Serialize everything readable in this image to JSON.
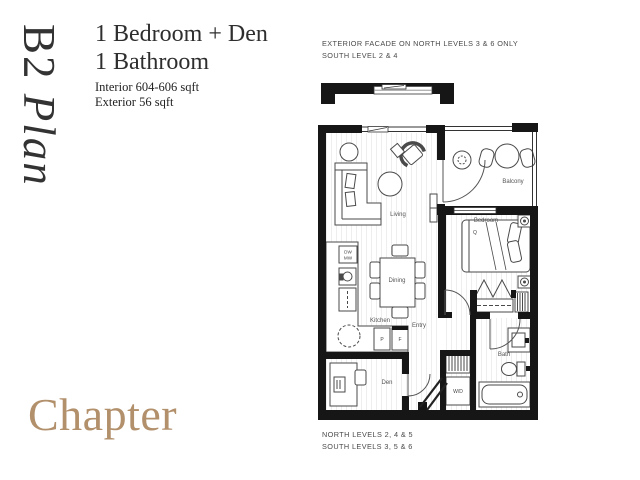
{
  "header": {
    "plan_code": "B2",
    "plan_word": "Plan",
    "title_line1": "1 Bedroom + Den",
    "title_line2": "1 Bathroom",
    "interior": "Interior 604-606 sqft",
    "exterior": "Exterior 56 sqft"
  },
  "facade_note": {
    "line1": "EXTERIOR FACADE ON NORTH LEVELS 3 & 6 ONLY",
    "line2": "SOUTH LEVEL 2 & 4"
  },
  "levels_note": {
    "line1": "NORTH LEVELS 2, 4 & 5",
    "line2": "SOUTH LEVELS 3, 5 & 6"
  },
  "brand": {
    "name": "Chapter",
    "color": "#b2906c"
  },
  "floorplan": {
    "labels": {
      "living": "Living",
      "dining": "Dining",
      "kitchen": "Kitchen",
      "den": "Den",
      "entry": "Entry",
      "balcony": "Balcony",
      "bedroom": "Bedroom",
      "bath": "Bath",
      "washer_dryer": "W/D",
      "dishwasher": "DW",
      "microwave": "MW",
      "pantry": "P",
      "fridge": "F",
      "bed_size": "Q"
    }
  }
}
